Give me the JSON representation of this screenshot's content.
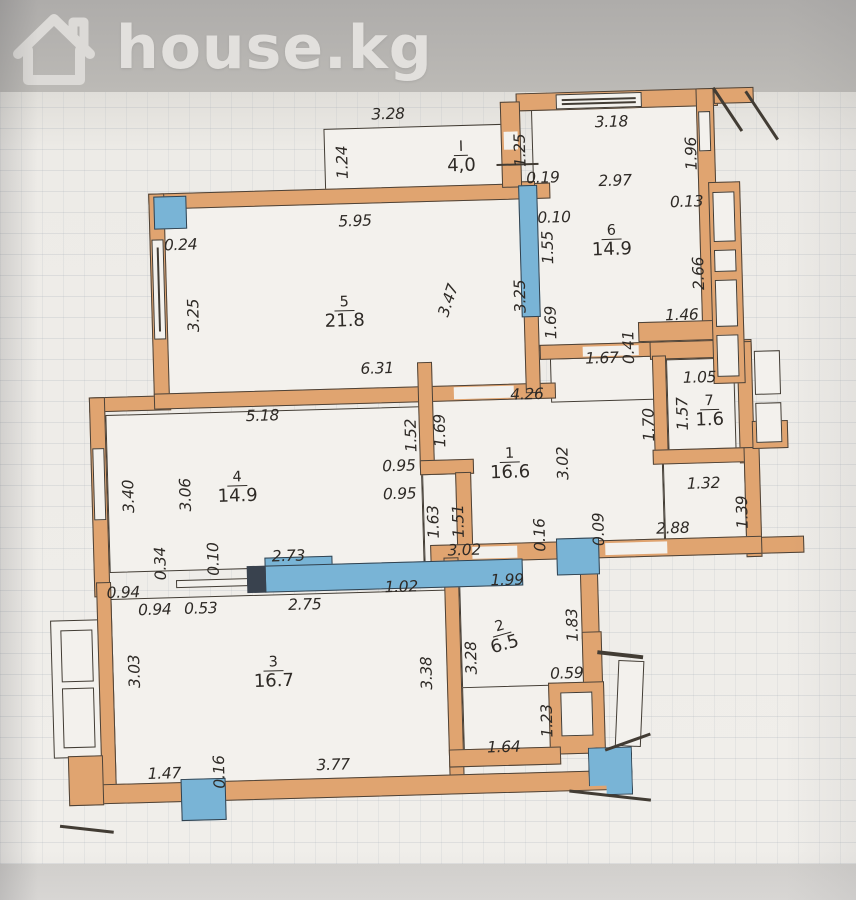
{
  "header": {
    "logo": "house.kg"
  },
  "colors": {
    "wall": "#e0a470",
    "window": "#79b4d6",
    "paper": "#f0eeea",
    "line": "#423c34",
    "header_bg": "#b4b2af",
    "logo_text": "#e2e0dd"
  },
  "plan": {
    "type": "apartment-floor-plan",
    "rooms": [
      {
        "number": "I",
        "area": "4,0"
      },
      {
        "number": "1",
        "area": "16.6"
      },
      {
        "number": "2",
        "area": "6.5"
      },
      {
        "number": "3",
        "area": "16.7"
      },
      {
        "number": "4",
        "area": "14.9"
      },
      {
        "number": "5",
        "area": "21.8"
      },
      {
        "number": "6",
        "area": "14.9"
      },
      {
        "number": "7",
        "area": "1.6"
      }
    ]
  },
  "dims": [
    "3.28",
    "1.24",
    "1.25",
    "0.19",
    "3.18",
    "1.96",
    "2.97",
    "0.13",
    "0.10",
    "1.55",
    "2.66",
    "0.24",
    "5.95",
    "3.25",
    "3.47",
    "3.25",
    "1.69",
    "0.41",
    "1.46",
    "6.31",
    "1.67",
    "4.26",
    "1.05",
    "1.57",
    "1.70",
    "5.18",
    "1.52",
    "1.69",
    "3.40",
    "3.06",
    "0.95",
    "0.95",
    "3.02",
    "1.32",
    "1.39",
    "1.63",
    "1.51",
    "0.34",
    "0.10",
    "2.73",
    "3.02",
    "0.16",
    "0.09",
    "2.88",
    "0.94",
    "0.94",
    "0.53",
    "2.75",
    "1.02",
    "1.99",
    "3.28",
    "1.83",
    "3.03",
    "3.38",
    "0.59",
    "1.23",
    "1.64",
    "1.47",
    "0.16",
    "3.77"
  ]
}
